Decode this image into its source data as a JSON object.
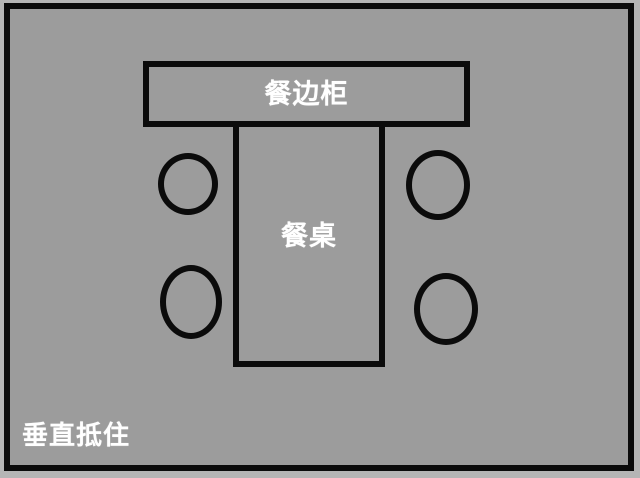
{
  "colors": {
    "outer_background": "#b5b5b5",
    "room_background": "#9c9c9c",
    "line": "#0b0b0b",
    "label_text": "#ffffff"
  },
  "diagram": {
    "type": "floor-plan",
    "sideboard": {
      "label": "餐边柜"
    },
    "table": {
      "label": "餐桌"
    },
    "chairs": [
      {
        "name": "chair-top-left"
      },
      {
        "name": "chair-bottom-left"
      },
      {
        "name": "chair-top-right"
      },
      {
        "name": "chair-bottom-right"
      }
    ],
    "annotation": {
      "label": "垂直抵住"
    }
  }
}
